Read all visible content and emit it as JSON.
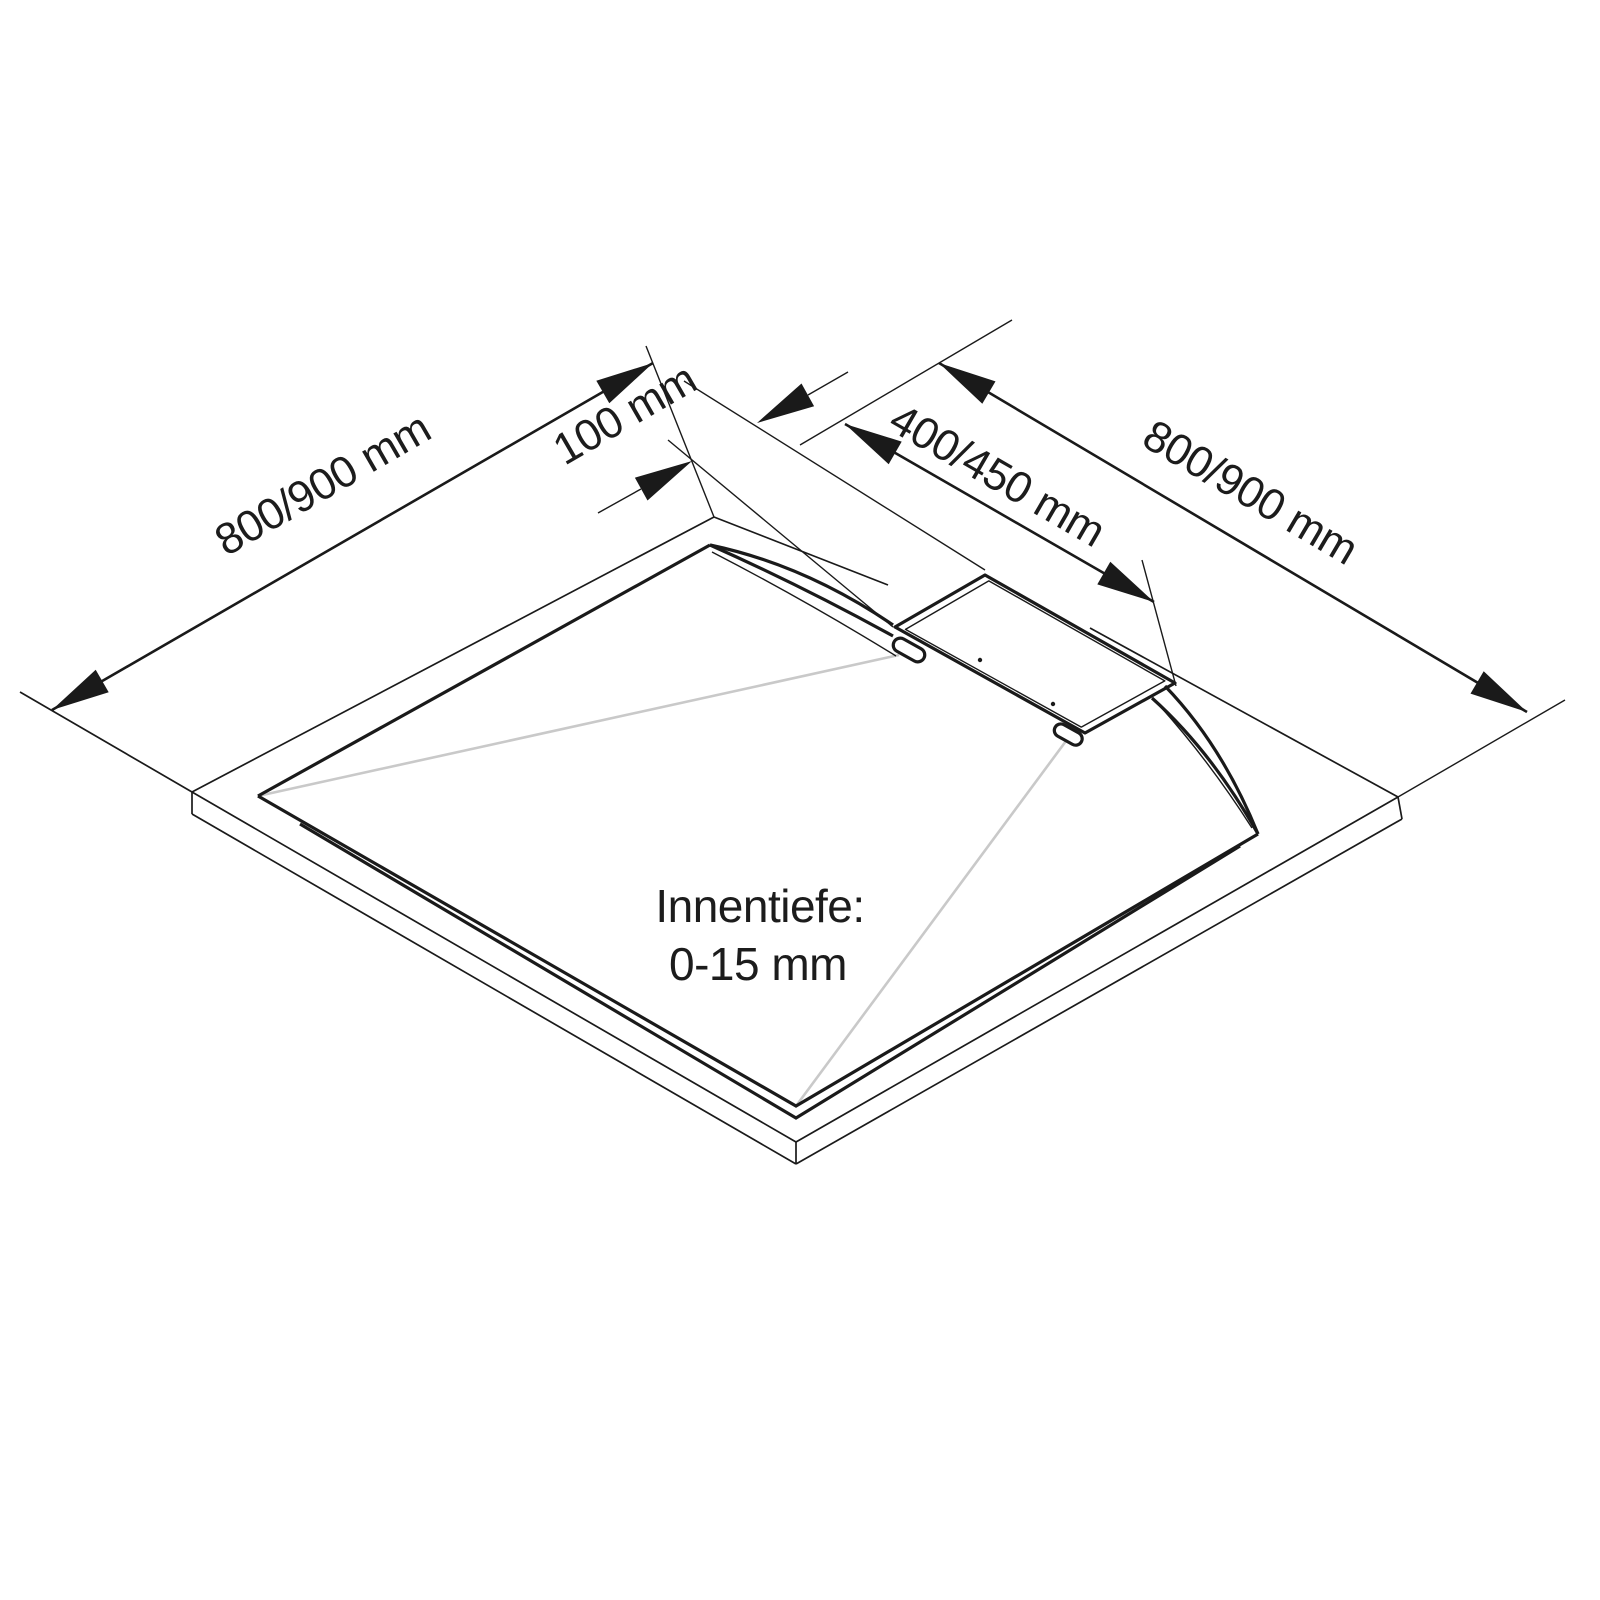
{
  "figure": {
    "type": "technical-drawing",
    "subject": "shower tray with linear drain, isometric dimension diagram",
    "background_color": "#ffffff",
    "line_color": "#1a1a1a",
    "slope_line_color": "#c9c9c9",
    "dimensions": {
      "left_edge_label": "800/900 mm",
      "offset_label": "100 mm",
      "drain_label": "400/450 mm",
      "right_edge_label": "800/900 mm"
    },
    "depth_note": {
      "line1": "Innentiefe:",
      "line2": "0-15 mm"
    }
  }
}
